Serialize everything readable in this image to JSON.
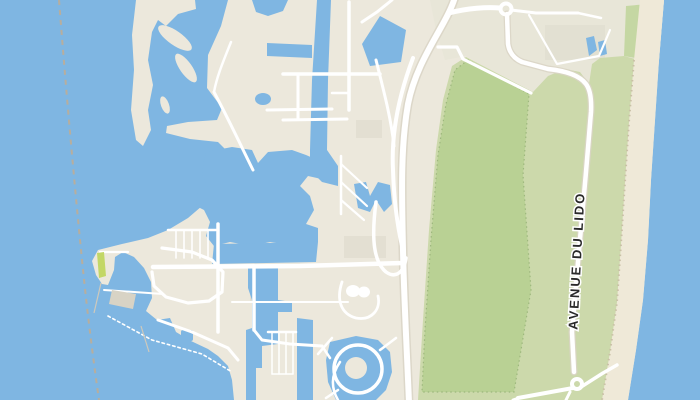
{
  "map": {
    "street_label": "AVENUE DU LIDO",
    "features": [
      "sea-water",
      "maritime-boundary-dashed-line",
      "sand-spit-island",
      "channel-islets",
      "marina-mainland",
      "marina-basin",
      "marina-canals",
      "harbor-bay",
      "boat-piers",
      "circular-lagoon-with-island",
      "main-road",
      "avenue-du-lido-road",
      "roundabout",
      "parking-loop",
      "golf-course-green",
      "coastal-green-belt",
      "beach-strip",
      "small-ponds",
      "swimming-pool"
    ]
  },
  "palette": {
    "water": "#7fb6e2",
    "land": "#ece8dc",
    "landAlt": "#e3dfd2",
    "paleZone": "#e8e6d8",
    "greenOuter": "#ccd9ab",
    "greenInner": "#b9d194",
    "greenStrip": "#c5d7a3",
    "beach": "#efe9d8",
    "beachDot": "#c9c0a6",
    "road": "#ffffff",
    "roadCasing": "#d9d4c6",
    "dashedLine": "#b7ae9e",
    "pier": "#d8d3c5",
    "pierLine": "#cfc9bb",
    "lime": "#c3d766",
    "labelText": "#2a2a2a",
    "labelHalo": "#ffffff"
  }
}
